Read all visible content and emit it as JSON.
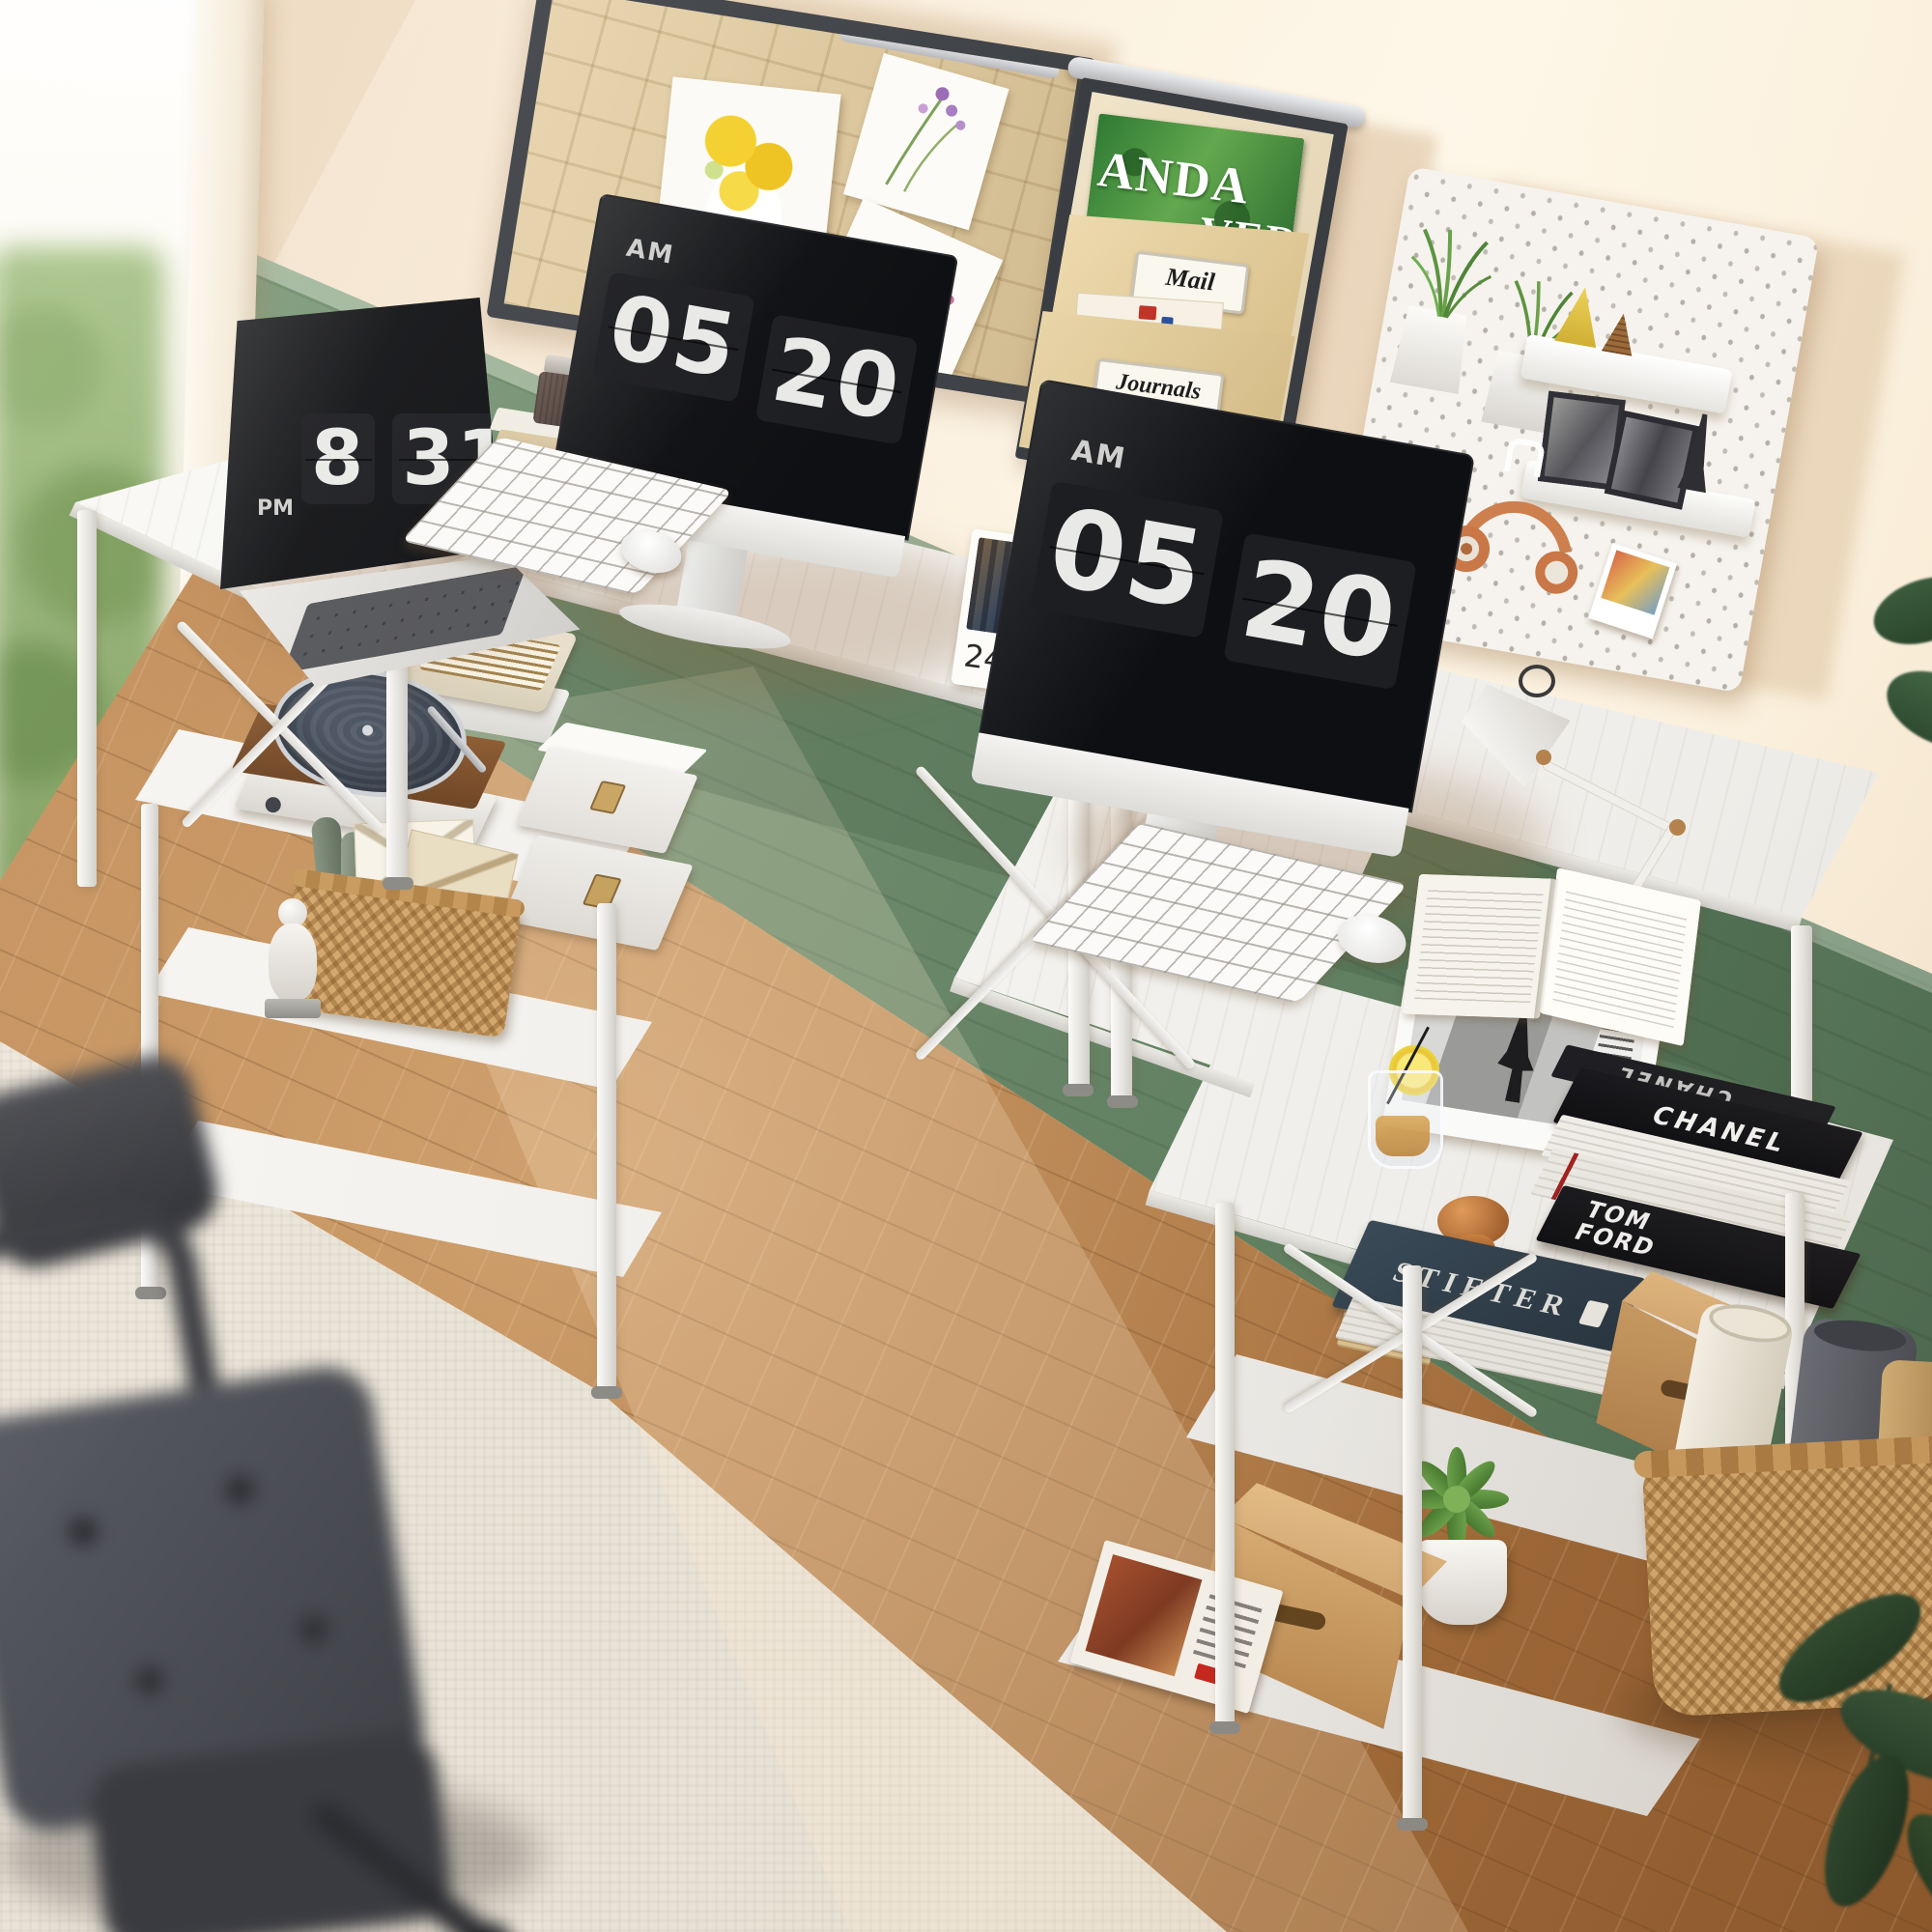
{
  "clocks": {
    "laptop": {
      "period": "PM",
      "hour": "8",
      "minute": "31"
    },
    "monitor_left": {
      "period": "AM",
      "hour": "05",
      "minute": "20"
    },
    "monitor_right": {
      "period": "AM",
      "hour": "05",
      "minute": "20"
    }
  },
  "desk_calendar": {
    "day": "24"
  },
  "wall_file_organizer": {
    "magazine_line1": "ANDA",
    "magazine_line2": "VER",
    "pocket_labels": [
      "Mail",
      "Journals"
    ]
  },
  "books": {
    "chanel_top": "CHANEL",
    "chanel_spine": "CHANEL",
    "tom_ford_spine": "TOM FORD",
    "blue_book_spine": "STIETER"
  },
  "colors": {
    "wall": "#f7e8d4",
    "wainscot_green": "#6e8b6c",
    "floor_wood": "#b57d48",
    "desk_white": "#f6f5f2",
    "frame_dark": "#3b3e43",
    "kraft_tan": "#e0cda2",
    "screen_black": "#141518",
    "clock_digits": "#e9e9e7",
    "calendar_ring_gold": "#c49033",
    "headphones_orange": "#cd7f4e",
    "plant_green": "#5d9440"
  }
}
